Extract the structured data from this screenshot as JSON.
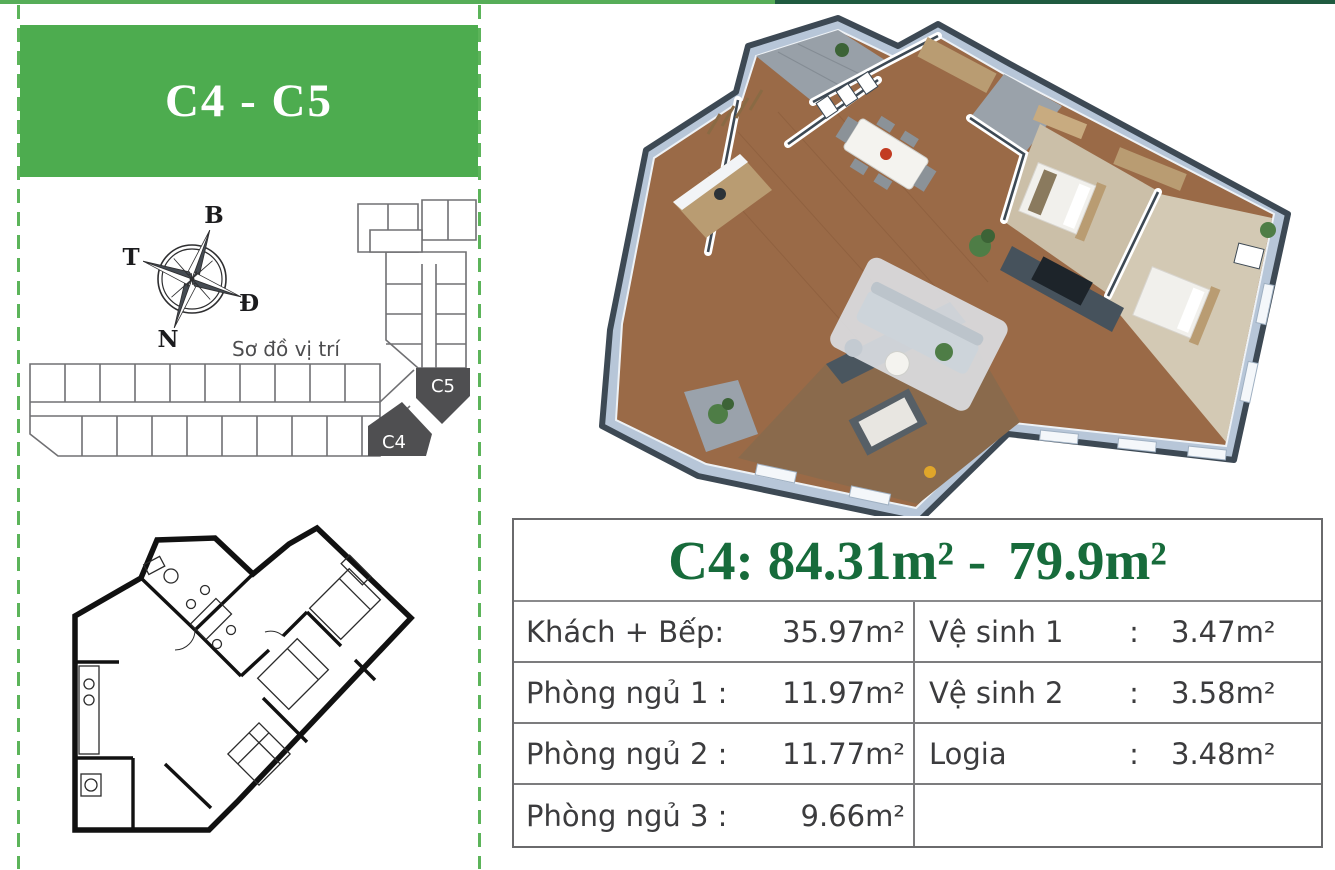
{
  "top_strip": {
    "left_color": "#56ad58",
    "right_color": "#1f5b40"
  },
  "left_panel": {
    "dash_color": "#5cb45a",
    "header": {
      "label": "C4 - C5",
      "background": "#4dac4f",
      "text_color": "#ffffff"
    },
    "compass": {
      "north_label": "B",
      "south_label": "N",
      "west_label": "T",
      "east_label": "Đ"
    },
    "location_map": {
      "caption": "Sơ đồ vị trí",
      "unit_labels": [
        "C5",
        "C4"
      ],
      "highlight_color": "#4f4f51",
      "outline_color": "#707073"
    },
    "floor_plan_2d": {
      "wall_color": "#111111"
    }
  },
  "right_panel": {
    "render_3d": {
      "wall_cap_color": "#3d4954",
      "facade_color": "#b7c6d8",
      "floor_wood_color": "#9a6a47",
      "carpet_color": "#cbbfa8",
      "plant_color": "#4e7d46"
    },
    "area_table": {
      "title": {
        "unit_label": "C4:",
        "gross_area": "84.31",
        "dash": "-",
        "net_area": "79.9",
        "area_unit": "m²",
        "text_color": "#176b3b"
      },
      "rows": [
        {
          "left_label": "Khách + Bếp:",
          "left_value": "35.97m²",
          "right_label": "Vệ sinh 1",
          "right_colon": ":",
          "right_value": "3.47m²"
        },
        {
          "left_label": "Phòng ngủ 1 :",
          "left_value": "11.97m²",
          "right_label": "Vệ sinh 2",
          "right_colon": ":",
          "right_value": "3.58m²"
        },
        {
          "left_label": "Phòng ngủ 2 :",
          "left_value": "11.77m²",
          "right_label": "Logia",
          "right_colon": ":",
          "right_value": "3.48m²"
        },
        {
          "left_label": "Phòng ngủ 3 :",
          "left_value": "9.66m²",
          "right_label": "",
          "right_colon": "",
          "right_value": ""
        }
      ]
    }
  }
}
